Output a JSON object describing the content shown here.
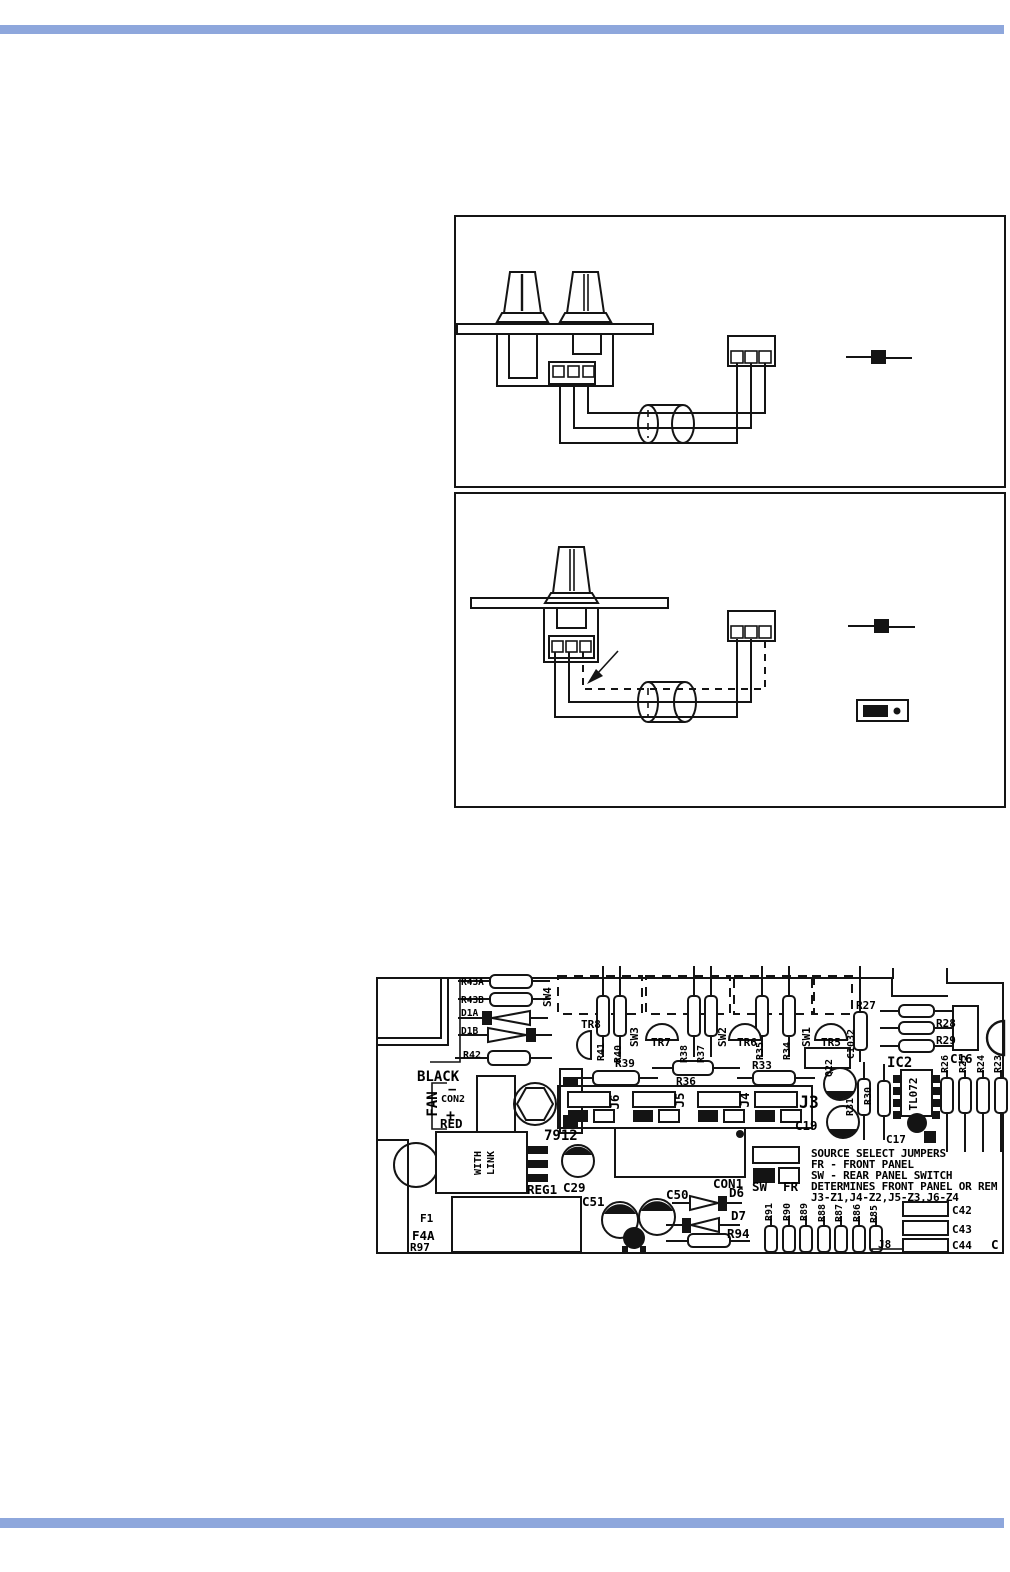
{
  "colors": {
    "bar": "#8EA7DC",
    "ink": "#141414"
  },
  "pcb": {
    "labels": {
      "r43a": "R43A",
      "r43b": "R43B",
      "d1a": "D1A",
      "d1b": "D1B",
      "r42": "R42",
      "black": "BLACK",
      "fan": "FAN",
      "con2": "CON2",
      "minus": "−",
      "plus": "+",
      "red": "RED",
      "sw4": "SW4",
      "tr8": "TR8",
      "r41": "R41",
      "r40": "R40",
      "sw3": "SW3",
      "tr7": "TR7",
      "r38": "R38",
      "r37": "R37",
      "sw2": "SW2",
      "tr6": "TR6",
      "r35": "R35",
      "r34": "R34",
      "sw1": "SW1",
      "tr5": "TR5",
      "c1032": "C1032",
      "r27": "R27",
      "r28": "R28",
      "r29": "R29",
      "c16": "C16",
      "ic2": "IC2",
      "tl072": "TL072",
      "r26": "R26",
      "r25": "R25",
      "r24": "R24",
      "r23": "R23",
      "r39": "R39",
      "r36": "R36",
      "r33": "R33",
      "j6": "J6",
      "j5": "J5",
      "j4": "J4",
      "j3": "J3",
      "reg7912": "7912",
      "with": "WITH",
      "link": "LINK",
      "reg1": "REG1",
      "c29": "C29",
      "f1": "F1",
      "f4a": "F4A",
      "r97": "R97",
      "c51": "C51",
      "c50": "C50",
      "con1": "CON1",
      "c19": "C19",
      "c17": "C17",
      "q22": "Q22",
      "r31": "R31",
      "r30": "R30",
      "d6": "D6",
      "d7": "D7",
      "r94": "R94",
      "r91": "R91",
      "r90": "R90",
      "r89": "R89",
      "r88": "R88",
      "r87": "R87",
      "r86": "R86",
      "r85": "R85",
      "j8": "J8",
      "c42": "C42",
      "c43": "C43",
      "c44": "C44",
      "c_corner": "C",
      "sw_jumper": "SW",
      "fr_jumper": "FR"
    },
    "note_lines": [
      "SOURCE SELECT JUMPERS",
      "FR - FRONT PANEL",
      "SW - REAR PANEL SWITCH",
      "DETERMINES FRONT PANEL OR REM",
      "J3-Z1,J4-Z2,J5-Z3,J6-Z4"
    ]
  }
}
